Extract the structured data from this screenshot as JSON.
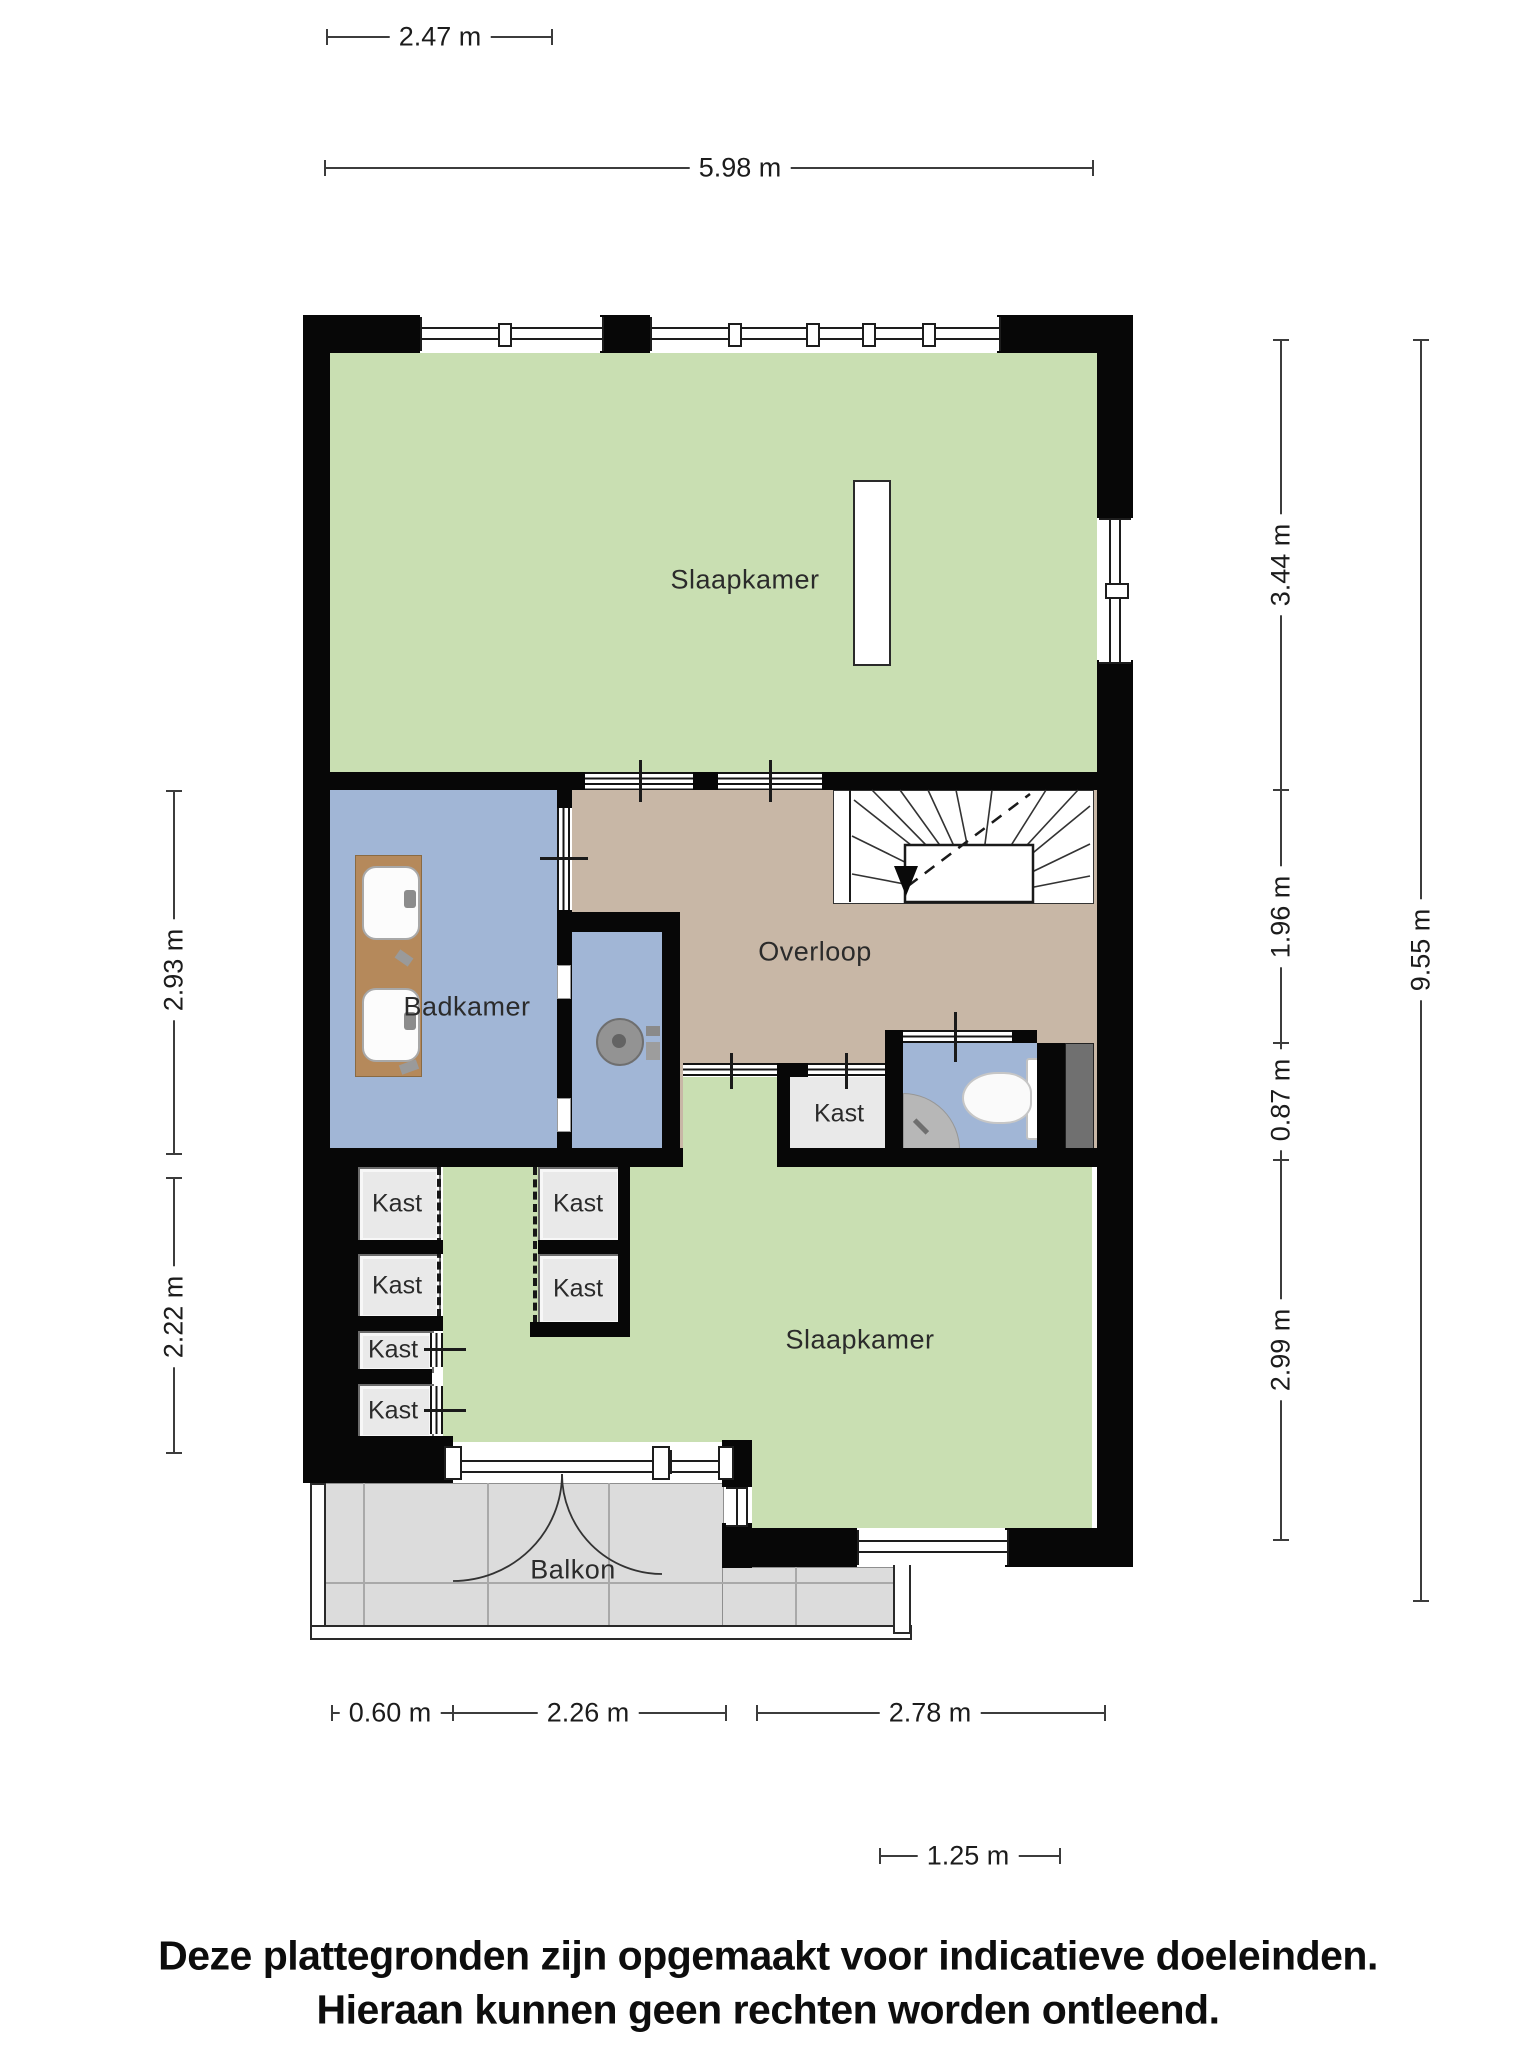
{
  "plan": {
    "rooms": {
      "bedroom_top": "Slaapkamer",
      "bathroom": "Badkamer",
      "landing": "Overloop",
      "closet": "Kast",
      "bedroom_bottom": "Slaapkamer",
      "balcony": "Balkon"
    },
    "dimensions": {
      "top_width_partial": "2.47 m",
      "top_width_total": "5.98 m",
      "right_seg1": "3.44 m",
      "right_seg2": "1.96 m",
      "right_seg3": "0.87 m",
      "right_seg4": "2.99 m",
      "right_total": "9.55 m",
      "left_seg1": "2.93 m",
      "left_seg2": "2.22 m",
      "bottom_seg1": "0.60 m",
      "bottom_seg2": "2.26 m",
      "bottom_seg3": "2.78 m",
      "bottom_seg4": "1.25 m"
    },
    "disclaimer": {
      "line1": "Deze plattegronden zijn opgemaakt voor indicatieve doeleinden.",
      "line2": "Hieraan kunnen geen rechten worden ontleend."
    },
    "colors": {
      "room-green": "#c9dfb2",
      "room-tan": "#c8b7a6",
      "room-blue": "#a1b6d6",
      "wood": "#b5895b",
      "closet-floor": "#e9e9e9",
      "balcony-floor": "#dcdcdc",
      "shaft": "#707070",
      "wall": "#070707",
      "dim": "#3c3c3c",
      "label": "#2b2b2b"
    }
  }
}
